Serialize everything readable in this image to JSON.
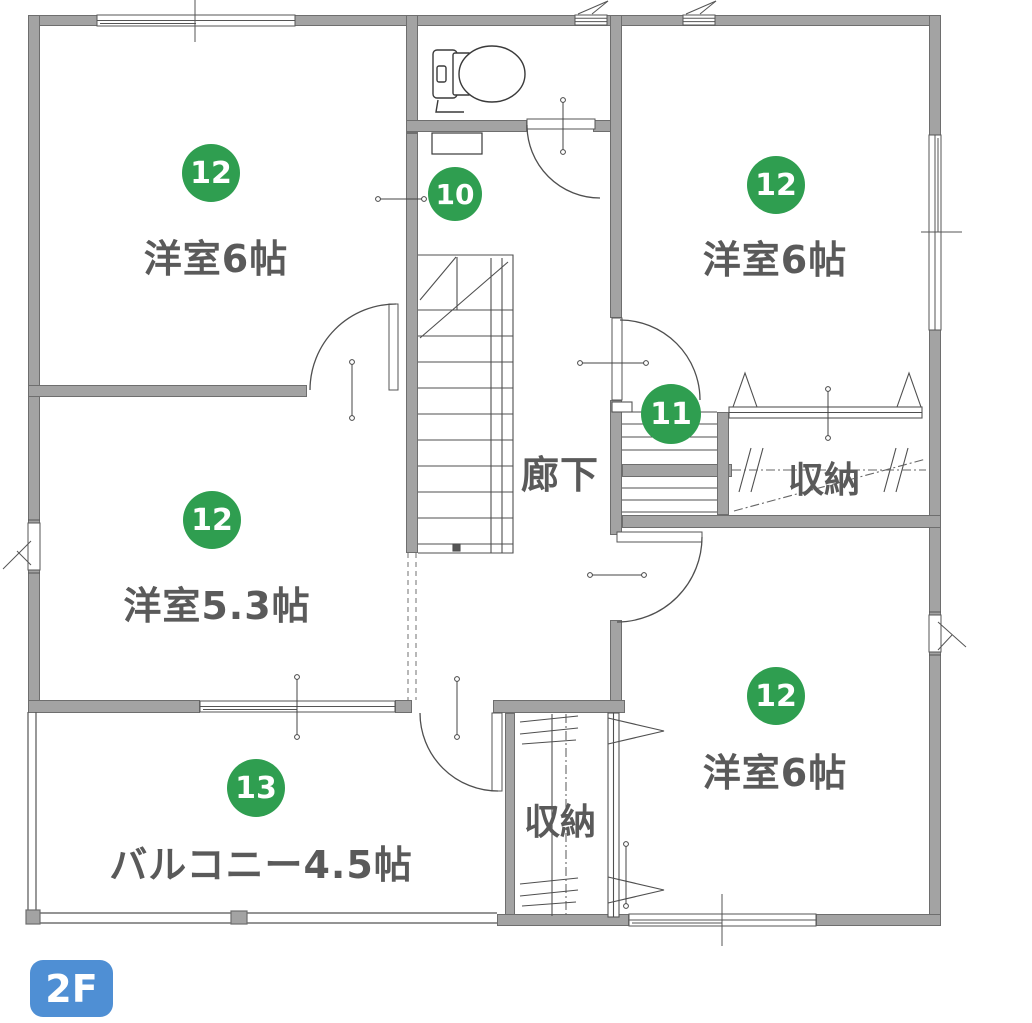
{
  "floor_badge": "2F",
  "colors": {
    "marker_green": "#2f9e50",
    "badge_blue": "#4f8fd4",
    "wall_gray": "#a3a3a3",
    "label_gray": "#5a5a5a",
    "line_dark": "#4f4f4f"
  },
  "rooms": {
    "bedroom_nw": {
      "marker": "12",
      "label": "洋室6帖"
    },
    "bedroom_ne": {
      "marker": "12",
      "label": "洋室6帖"
    },
    "bedroom_w": {
      "marker": "12",
      "label": "洋室5.3帖"
    },
    "bedroom_se": {
      "marker": "12",
      "label": "洋室6帖"
    },
    "balcony": {
      "marker": "13",
      "label": "バルコニー4.5帖"
    },
    "toilet": {
      "marker": "10"
    },
    "stairs": {
      "marker": "11"
    },
    "corridor": {
      "label": "廊下"
    },
    "closet_e": {
      "label": "収納"
    },
    "closet_s": {
      "label": "収納"
    }
  }
}
